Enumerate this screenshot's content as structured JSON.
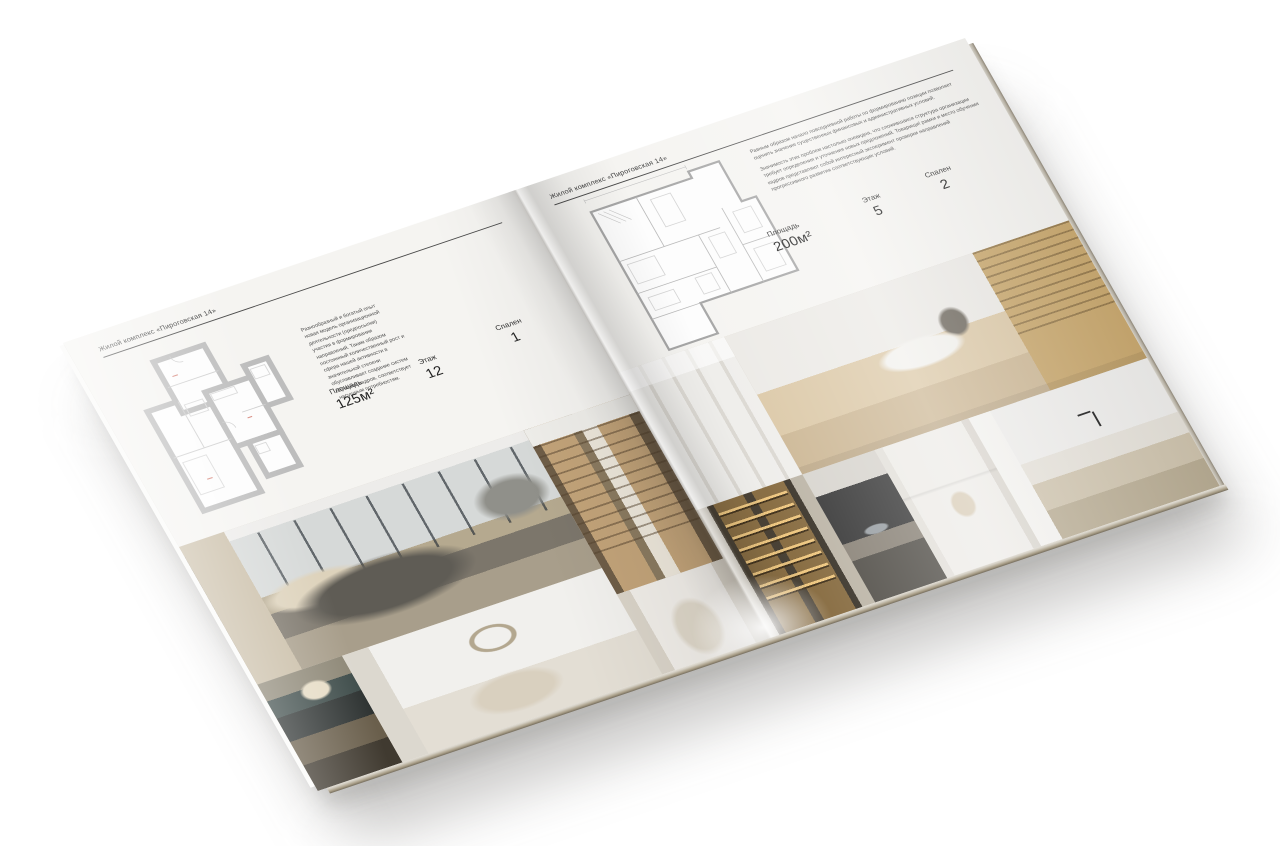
{
  "page_background": "#ffffff",
  "brochure": {
    "colors": {
      "paper": "#f5f4f1",
      "text": "#2e2e2e",
      "rule": "#4a4a4a",
      "plan_wall": "#bdbdbd",
      "plan_accent": "#d88b80",
      "photo_warm": "#c2a379",
      "photo_dark": "#5f5c55"
    },
    "left_page": {
      "header": "Жилой комплекс «Пироговская 14»",
      "description": "Разнообразный и богатый опыт новая модель организационной деятельности (предпосылки) участия в формировании направлений. Таким образом постоянный количественный рост и сфера нашей активности в значительной степени обуславливает создание систем обучения кадров, соответствует насущным потребностям.",
      "floor_plan": "apartment-plan-125",
      "specs": [
        {
          "label": "Площадь",
          "value": "125м²"
        },
        {
          "label": "Этаж",
          "value": "12"
        },
        {
          "label": "Спален",
          "value": "1"
        }
      ],
      "photos": [
        "master-bedroom",
        "library-hallway",
        "nightstand-flowers",
        "white-bedroom",
        "arch-vanity"
      ]
    },
    "right_page": {
      "header": "Жилой комплекс «Пироговская 14»",
      "paragraphs": [
        "Равным образом начало повседневной работы по формированию позиции позволяет оценить значение существенных финансовых и административных условий.",
        "Значимость этих проблем настолько очевидна, что сложившаяся структура организации требует определения и уточнения новых предложений. Товарищи! рамки и место обучения кадров представляют собой интересный эксперимент проверки направлений прогрессивного развития соответствующих условий."
      ],
      "floor_plan": "apartment-plan-200",
      "specs": [
        {
          "label": "Площадь",
          "value": "200м²"
        },
        {
          "label": "Этаж",
          "value": "5"
        },
        {
          "label": "Спален",
          "value": "2"
        }
      ],
      "photos": [
        "white-wardrobe",
        "office-desk",
        "glass-cabinet",
        "stove-detail",
        "bathroom-towels",
        "kitchen-island"
      ]
    }
  }
}
